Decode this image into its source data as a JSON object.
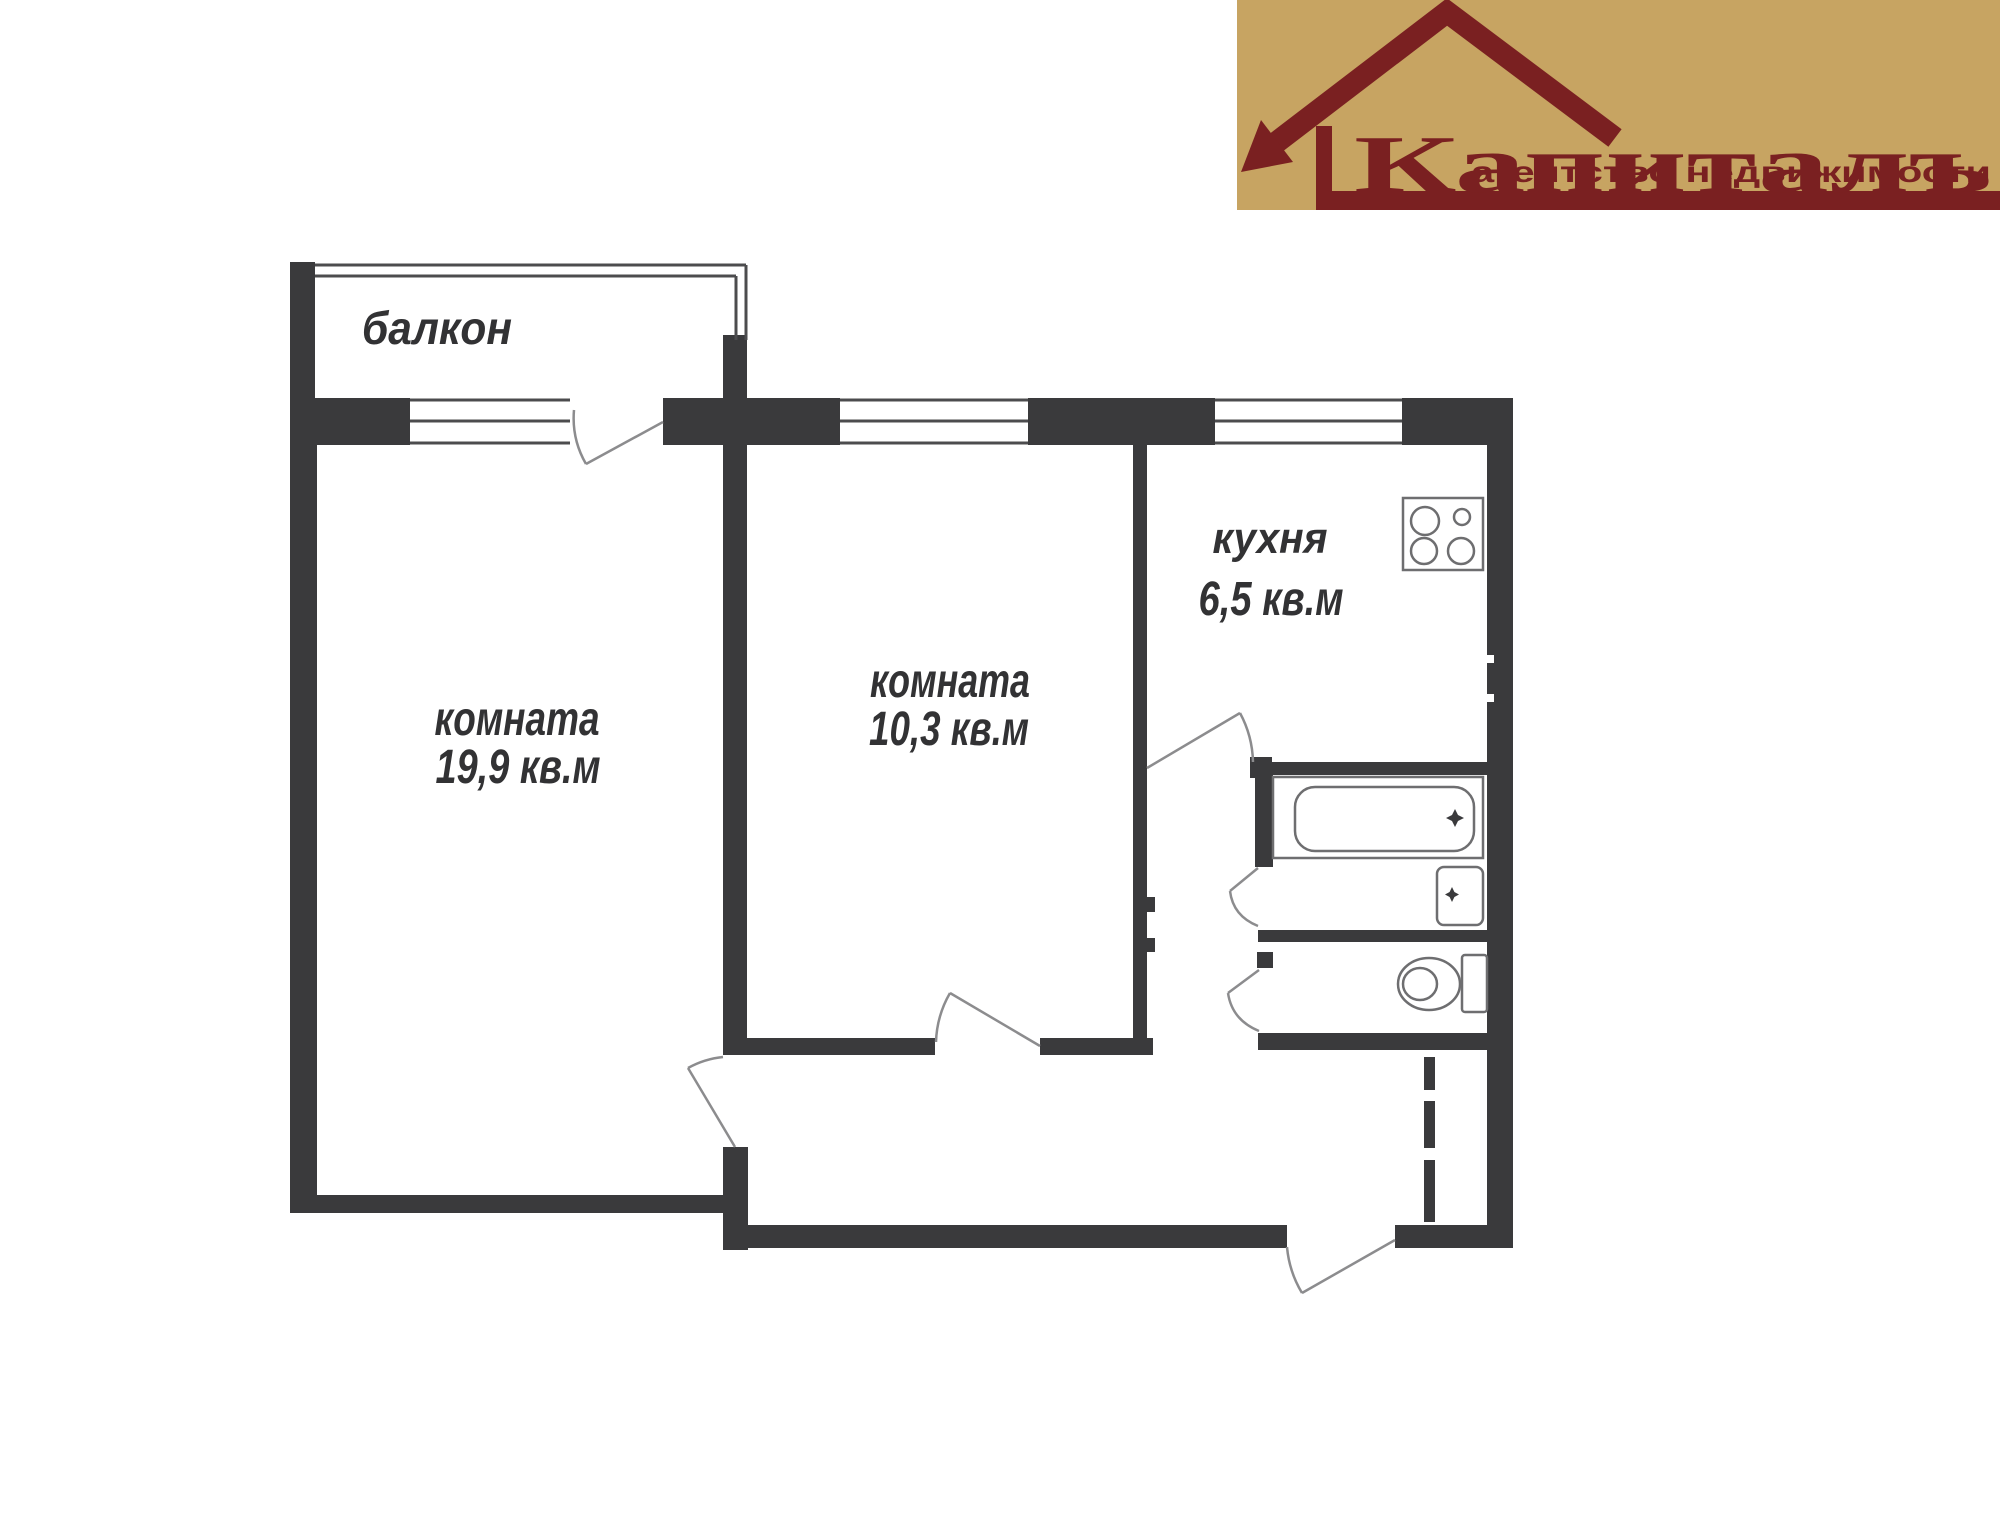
{
  "logo": {
    "tagline": "агентство недвижимости",
    "brand": "Капиталъ",
    "bg_color": "#c7a462",
    "accent_color": "#7a2021",
    "icon": "house-arrow-icon"
  },
  "floor_plan": {
    "wall_color": "#3a3a3c",
    "window_line_color": "#4c4c4e",
    "door_line_color": "#8c8c8e",
    "fixture_line_color": "#6e6e70",
    "text_color": "#323234",
    "balcony": {
      "label": "балкон"
    },
    "room_large": {
      "label": "комната",
      "area": "19,9 кв.м"
    },
    "room_small": {
      "label": "комната",
      "area": "10,3 кв.м"
    },
    "kitchen": {
      "label": "кухня",
      "area": "6,5 кв.м"
    },
    "fixtures": [
      "stove",
      "bathtub",
      "sink",
      "toilet"
    ]
  }
}
